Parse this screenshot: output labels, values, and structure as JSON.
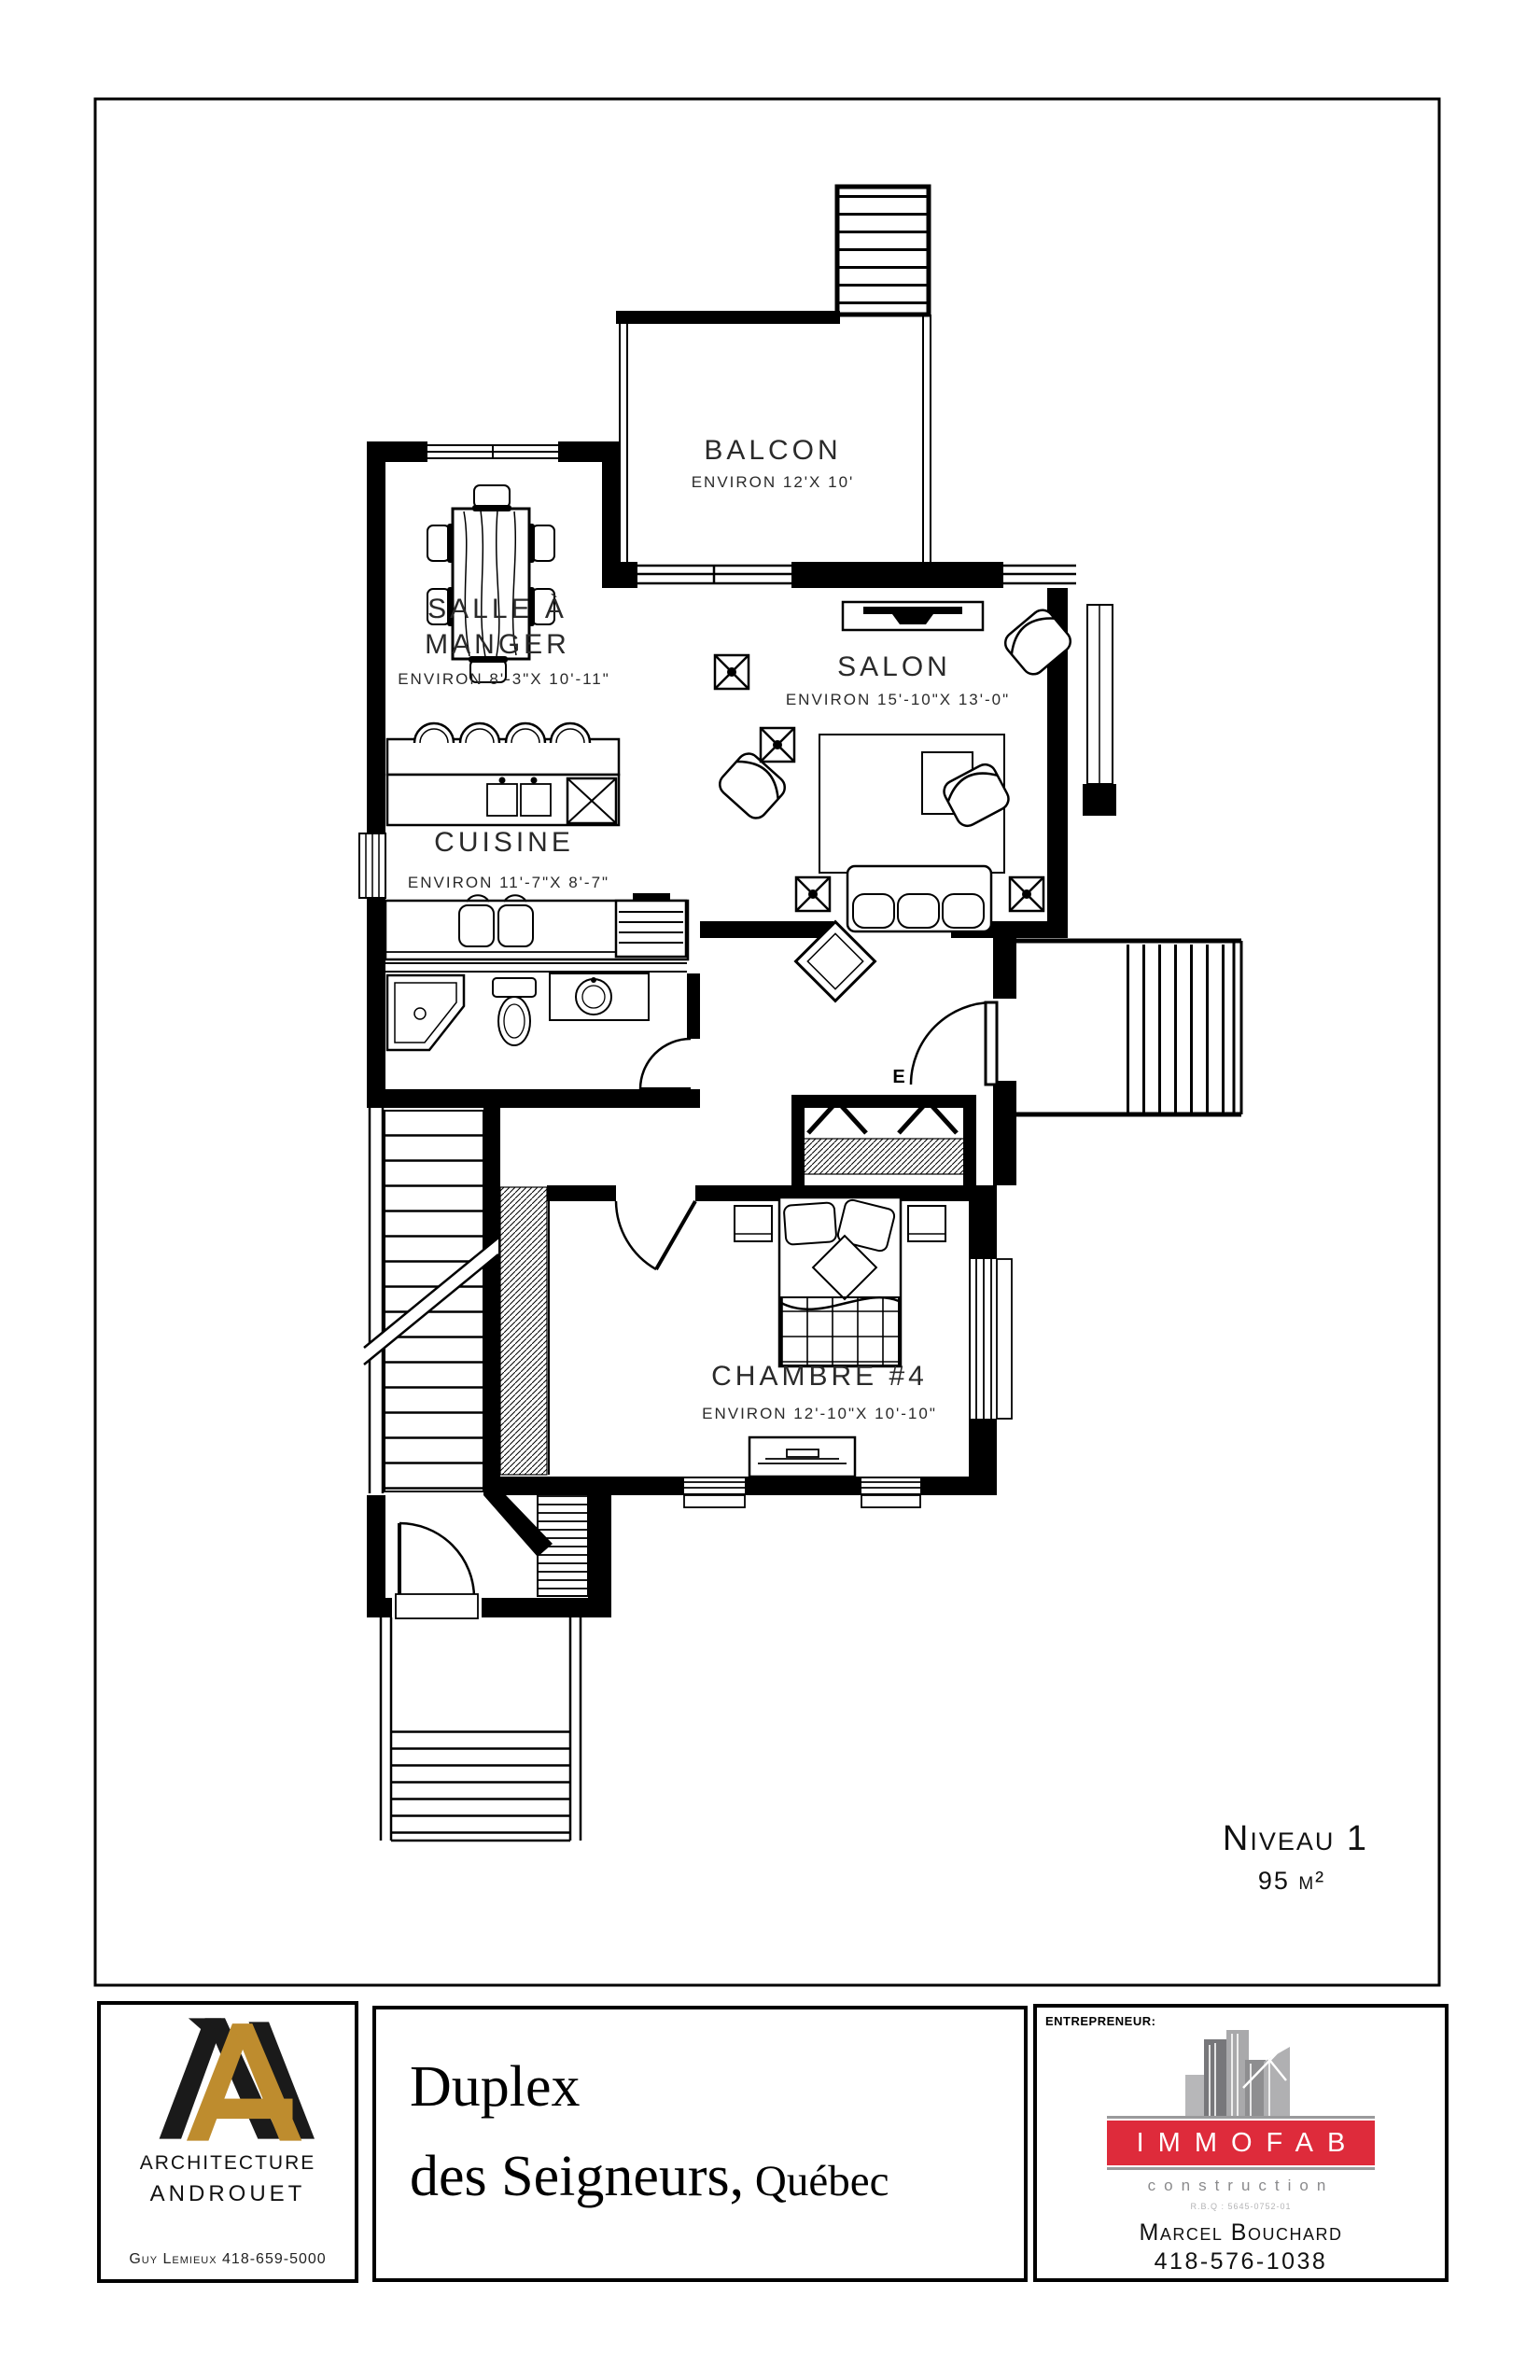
{
  "plan": {
    "rooms": [
      {
        "id": "balcon",
        "name": "BALCON",
        "dims": "ENVIRON 12'X 10'"
      },
      {
        "id": "salle-a-manger",
        "line1": "SALLE À",
        "line2": "MANGER",
        "dims": "ENVIRON 8'-3\"X 10'-11\""
      },
      {
        "id": "salon",
        "name": "SALON",
        "dims": "ENVIRON 15'-10\"X 13'-0\""
      },
      {
        "id": "cuisine",
        "name": "CUISINE",
        "dims": "ENVIRON 11'-7\"X 8'-7\""
      },
      {
        "id": "chambre4",
        "name": "CHAMBRE #4",
        "dims": "ENVIRON 12'-10\"X 10'-10\""
      }
    ],
    "level": {
      "name": "Niveau 1",
      "area": "95 m²"
    },
    "electrical_panel": "E"
  },
  "title_block": {
    "architect": {
      "firm_line1": "ARCHITECTURE",
      "firm_line2": "ANDROUET",
      "contact": "Guy Lemieux 418-659-5000",
      "logo_gold": "#BE8C2E",
      "logo_black": "#1A1A1A"
    },
    "project": {
      "line1": "Duplex",
      "line2": "des Seigneurs,",
      "location": " Québec"
    },
    "contractor": {
      "label": "ENTREPRENEUR:",
      "company": "IMMOFAB",
      "tagline": "construction",
      "license": "R.B.Q : 5645-0752-01",
      "name": "Marcel Bouchard",
      "phone": "418-576-1038",
      "banner_red": "#DE2B3B",
      "building_gray": "#9B9B9E"
    }
  }
}
